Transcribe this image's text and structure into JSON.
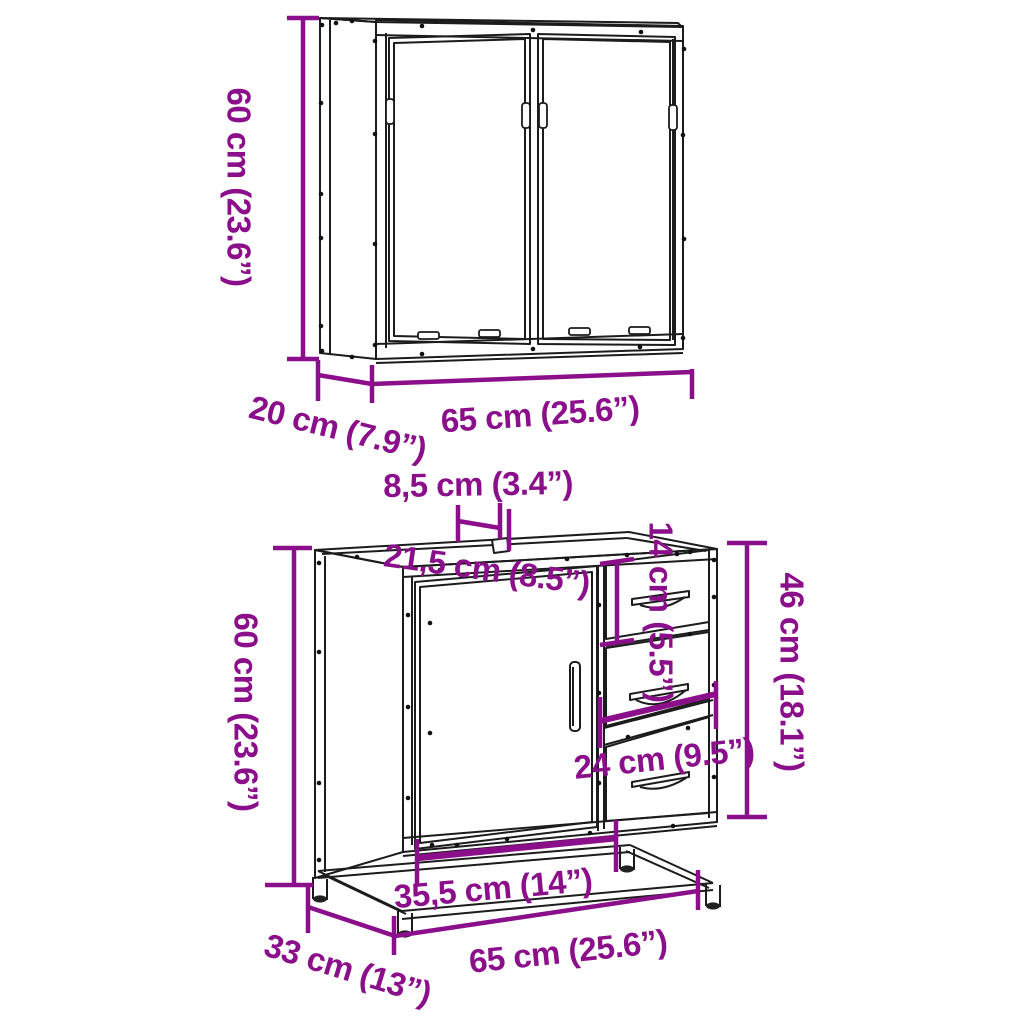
{
  "colors": {
    "dimension_accent": "#8b0f8b",
    "line_art": "#1c1c1c",
    "background": "#ffffff"
  },
  "labels": {
    "mirror_cabinet": {
      "height": "60 cm (23.6”)",
      "depth": "20 cm (7.9”)",
      "width": "65 cm (25.6”)"
    },
    "vanity_cabinet": {
      "height": "60 cm (23.6”)",
      "sink_hole_depth": "8,5 cm (3.4”)",
      "sink_hole_offset": "21,5 cm (8.5”)",
      "top_drawer_height": "14 cm (5.5”)",
      "drawer_section_height": "46 cm (18.1”)",
      "drawer_width": "24 cm (9.5”)",
      "door_width": "35,5 cm (14”)",
      "width": "65 cm (25.6”)",
      "depth": "33 cm (13”)"
    }
  }
}
